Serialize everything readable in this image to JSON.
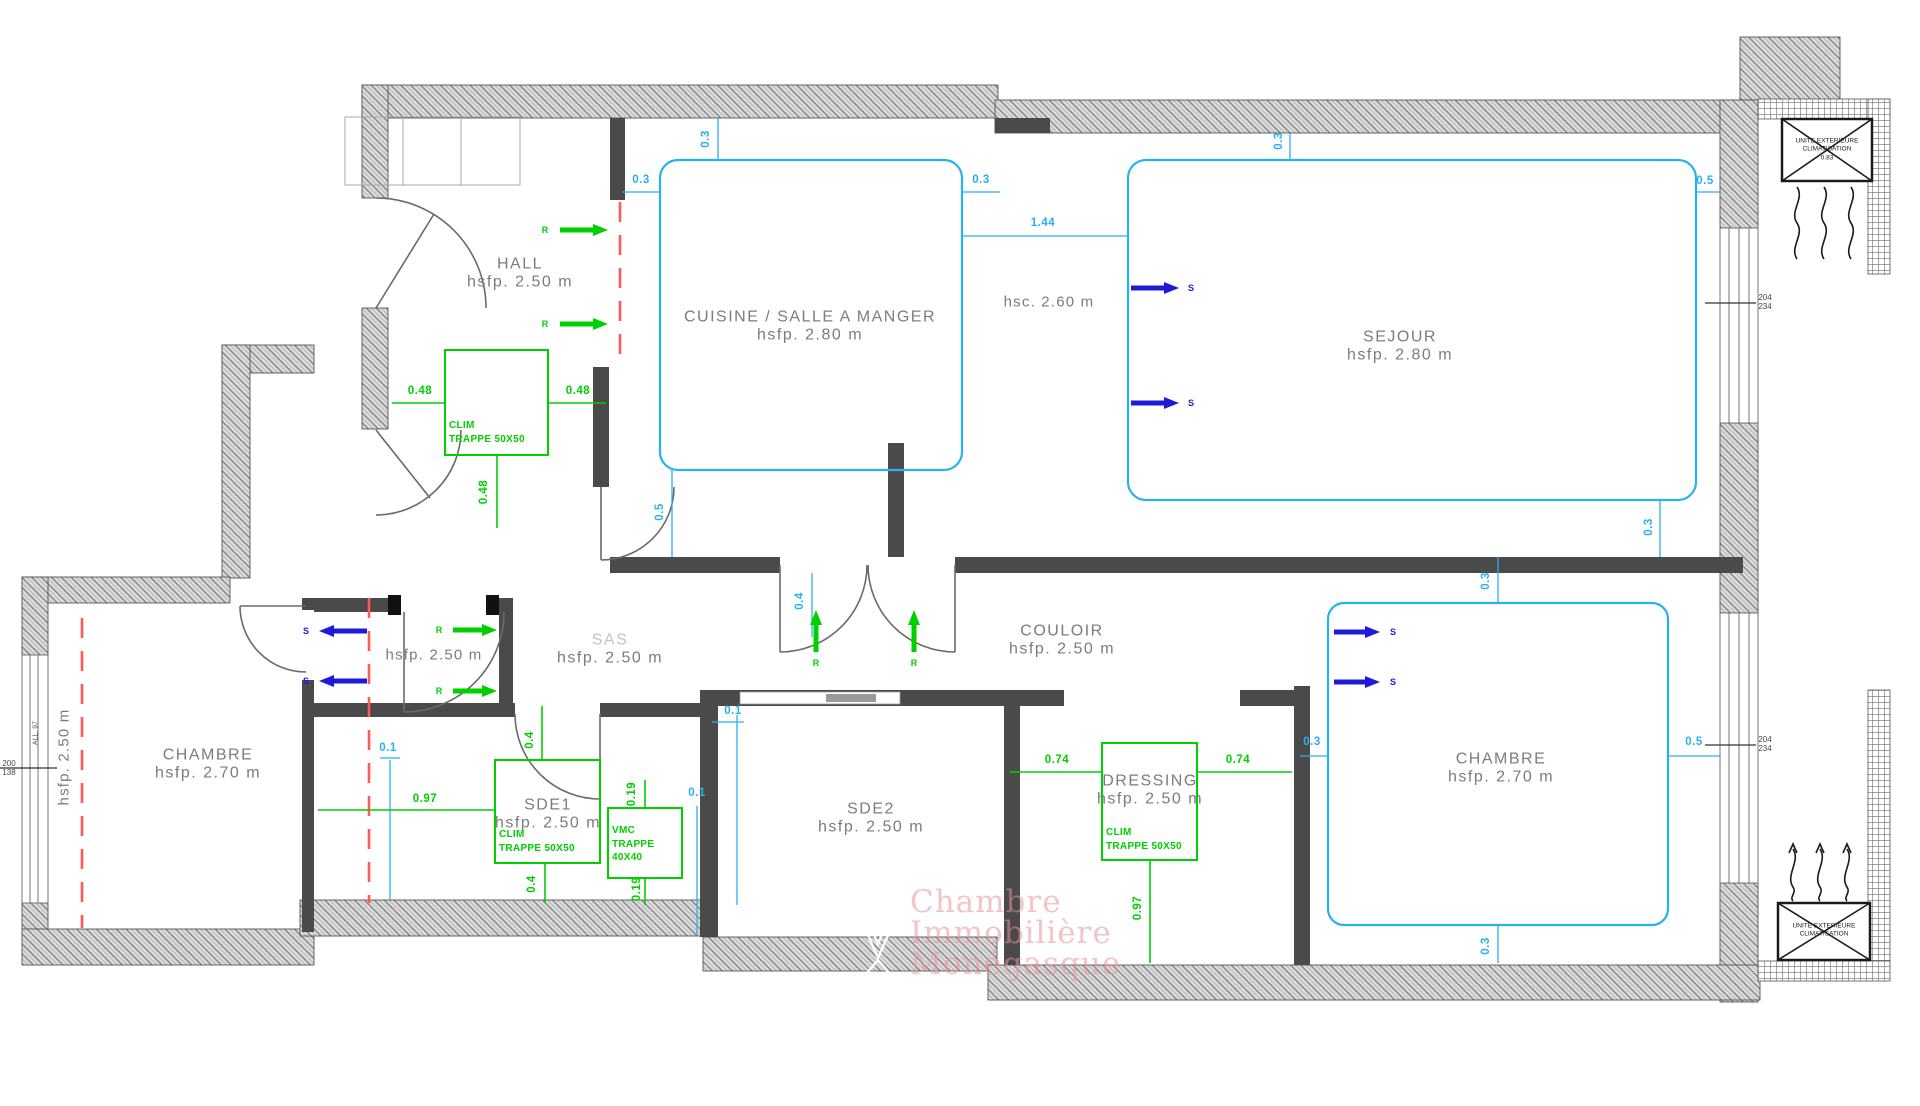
{
  "colors": {
    "wall": "#4a4a4a",
    "hatch_stroke": "#8d8d8d",
    "cyan": "#29b1ef",
    "green": "#00cf00",
    "blue": "#1b1bd8",
    "red_dash": "#ff5a55",
    "room_label": "#7c7c7c",
    "watermark": "#e894 9c"
  },
  "rooms": [
    {
      "name": "HALL",
      "height": "hsfp. 2.50 m",
      "x": 520,
      "y": 274
    },
    {
      "name": "CUISINE / SALLE A MANGER",
      "height": "hsfp. 2.80 m",
      "x": 810,
      "y": 327
    },
    {
      "name": "SEJOUR",
      "height": "hsfp. 2.80 m",
      "x": 1400,
      "y": 347
    },
    {
      "name": "CHAMBRE",
      "height": "hsfp. 2.70 m",
      "x": 208,
      "y": 765
    },
    {
      "name": "SAS",
      "height": "hsfp. 2.50 m",
      "x": 610,
      "y": 650,
      "light": true
    },
    {
      "name": "SDE1",
      "height": "hsfp. 2.50 m",
      "x": 548,
      "y": 815
    },
    {
      "name": "SDE2",
      "height": "hsfp. 2.50 m",
      "x": 871,
      "y": 819
    },
    {
      "name": "COULOIR",
      "height": "hsfp. 2.50 m",
      "x": 1062,
      "y": 641
    },
    {
      "name": "DRESSING",
      "height": "hsfp. 2.50 m",
      "x": 1150,
      "y": 791
    },
    {
      "name": "CHAMBRE",
      "height": "hsfp. 2.70 m",
      "x": 1501,
      "y": 769
    }
  ],
  "texts": [
    {
      "t": "hsc. 2.60 m",
      "x": 1049,
      "y": 302,
      "rot": false
    },
    {
      "t": "hsfp. 2.50 m",
      "x": 434,
      "y": 655,
      "rot": false
    },
    {
      "t": "hsfp. 2.50 m",
      "x": 64,
      "y": 757,
      "rot": true
    }
  ],
  "dims": [
    {
      "t": "0.3",
      "x": 641,
      "y": 180,
      "c": "cy",
      "rot": false
    },
    {
      "t": "0.3",
      "x": 706,
      "y": 139,
      "c": "cy",
      "rot": true
    },
    {
      "t": "0.3",
      "x": 981,
      "y": 180,
      "c": "cy",
      "rot": false
    },
    {
      "t": "1.44",
      "x": 1043,
      "y": 223,
      "c": "cy",
      "rot": false
    },
    {
      "t": "0.3",
      "x": 1279,
      "y": 141,
      "c": "cy",
      "rot": true
    },
    {
      "t": "0.5",
      "x": 1705,
      "y": 181,
      "c": "cy",
      "rot": false
    },
    {
      "t": "0.5",
      "x": 660,
      "y": 512,
      "c": "cy",
      "rot": true
    },
    {
      "t": "0.3",
      "x": 1649,
      "y": 527,
      "c": "cy",
      "rot": true
    },
    {
      "t": "0.4",
      "x": 800,
      "y": 601,
      "c": "cy",
      "rot": true
    },
    {
      "t": "0.3",
      "x": 1486,
      "y": 581,
      "c": "cy",
      "rot": true
    },
    {
      "t": "0.3",
      "x": 1312,
      "y": 742,
      "c": "cy",
      "rot": false
    },
    {
      "t": "0.5",
      "x": 1694,
      "y": 742,
      "c": "cy",
      "rot": false
    },
    {
      "t": "0.3",
      "x": 1486,
      "y": 946,
      "c": "cy",
      "rot": true
    },
    {
      "t": "0.1",
      "x": 733,
      "y": 711,
      "c": "cy",
      "rot": false
    },
    {
      "t": "0.1",
      "x": 697,
      "y": 793,
      "c": "cy",
      "rot": false
    },
    {
      "t": "0.1",
      "x": 388,
      "y": 748,
      "c": "cy",
      "rot": false
    },
    {
      "t": "0.48",
      "x": 420,
      "y": 391,
      "c": "gr",
      "rot": false
    },
    {
      "t": "0.48",
      "x": 578,
      "y": 391,
      "c": "gr",
      "rot": false
    },
    {
      "t": "0.48",
      "x": 484,
      "y": 492,
      "c": "gr",
      "rot": true
    },
    {
      "t": "0.97",
      "x": 425,
      "y": 799,
      "c": "gr",
      "rot": false
    },
    {
      "t": "0.4",
      "x": 530,
      "y": 740,
      "c": "gr",
      "rot": true
    },
    {
      "t": "0.4",
      "x": 532,
      "y": 884,
      "c": "gr",
      "rot": true
    },
    {
      "t": "0.19",
      "x": 632,
      "y": 794,
      "c": "gr",
      "rot": true
    },
    {
      "t": "0.19",
      "x": 637,
      "y": 889,
      "c": "gr",
      "rot": true
    },
    {
      "t": "0.74",
      "x": 1057,
      "y": 760,
      "c": "gr",
      "rot": false
    },
    {
      "t": "0.74",
      "x": 1238,
      "y": 760,
      "c": "gr",
      "rot": false
    },
    {
      "t": "0.97",
      "x": 1138,
      "y": 908,
      "c": "gr",
      "rot": true
    }
  ],
  "equip": [
    {
      "lines": [
        "CLIM",
        "TRAPPE 50X50"
      ],
      "x": 449,
      "y": 419
    },
    {
      "lines": [
        "CLIM",
        "TRAPPE 50X50"
      ],
      "x": 499,
      "y": 828
    },
    {
      "lines": [
        "VMC",
        "TRAPPE",
        "40X40"
      ],
      "x": 612,
      "y": 824
    },
    {
      "lines": [
        "CLIM",
        "TRAPPE 50X50"
      ],
      "x": 1106,
      "y": 826
    }
  ],
  "arrows": [
    {
      "dir": "right",
      "x": 560,
      "y": 230,
      "len": 48,
      "type": "return",
      "label": "R",
      "lx": 545,
      "ly": 230
    },
    {
      "dir": "right",
      "x": 560,
      "y": 324,
      "len": 48,
      "type": "return",
      "label": "R",
      "lx": 545,
      "ly": 324
    },
    {
      "dir": "right",
      "x": 453,
      "y": 630,
      "len": 44,
      "type": "return",
      "label": "R",
      "lx": 439,
      "ly": 630
    },
    {
      "dir": "right",
      "x": 453,
      "y": 691,
      "len": 44,
      "type": "return",
      "label": "R",
      "lx": 439,
      "ly": 691
    },
    {
      "dir": "up",
      "x": 816,
      "y": 652,
      "len": 42,
      "type": "return",
      "label": "R",
      "lx": 816,
      "ly": 663
    },
    {
      "dir": "up",
      "x": 914,
      "y": 652,
      "len": 42,
      "type": "return",
      "label": "R",
      "lx": 914,
      "ly": 663
    },
    {
      "dir": "right",
      "x": 1131,
      "y": 288,
      "len": 48,
      "type": "supply",
      "label": "S",
      "lx": 1191,
      "ly": 288
    },
    {
      "dir": "right",
      "x": 1131,
      "y": 403,
      "len": 48,
      "type": "supply",
      "label": "S",
      "lx": 1191,
      "ly": 403
    },
    {
      "dir": "left",
      "x": 367,
      "y": 631,
      "len": 48,
      "type": "supply",
      "label": "S",
      "lx": 306,
      "ly": 631
    },
    {
      "dir": "left",
      "x": 367,
      "y": 681,
      "len": 48,
      "type": "supply",
      "label": "S",
      "lx": 306,
      "ly": 681
    },
    {
      "dir": "right",
      "x": 1334,
      "y": 632,
      "len": 46,
      "type": "supply",
      "label": "S",
      "lx": 1393,
      "ly": 632
    },
    {
      "dir": "right",
      "x": 1334,
      "y": 682,
      "len": 46,
      "type": "supply",
      "label": "S",
      "lx": 1393,
      "ly": 682
    }
  ],
  "window_tags": [
    {
      "lines": [
        "204",
        "234"
      ],
      "x": 1765,
      "y": 302
    },
    {
      "lines": [
        "204",
        "234"
      ],
      "x": 1765,
      "y": 744
    },
    {
      "lines": [
        "200",
        "138"
      ],
      "x": 9,
      "y": 768
    }
  ],
  "sill_tag": {
    "t": "ALL. 97",
    "x": 36,
    "y": 733
  },
  "ac_units": [
    {
      "lines": [
        "UNITE EXTERIEURE",
        "CLIMATISATION",
        "0.83"
      ],
      "x": 1827,
      "y": 150
    },
    {
      "lines": [
        "UNITE EXTERIEURE",
        "CLIMATISATION"
      ],
      "x": 1824,
      "y": 931
    }
  ],
  "watermark": {
    "lines": [
      "Chambre",
      "Immobilière",
      "Monégasque"
    ],
    "x": 910,
    "y": 884,
    "lh": 31
  }
}
